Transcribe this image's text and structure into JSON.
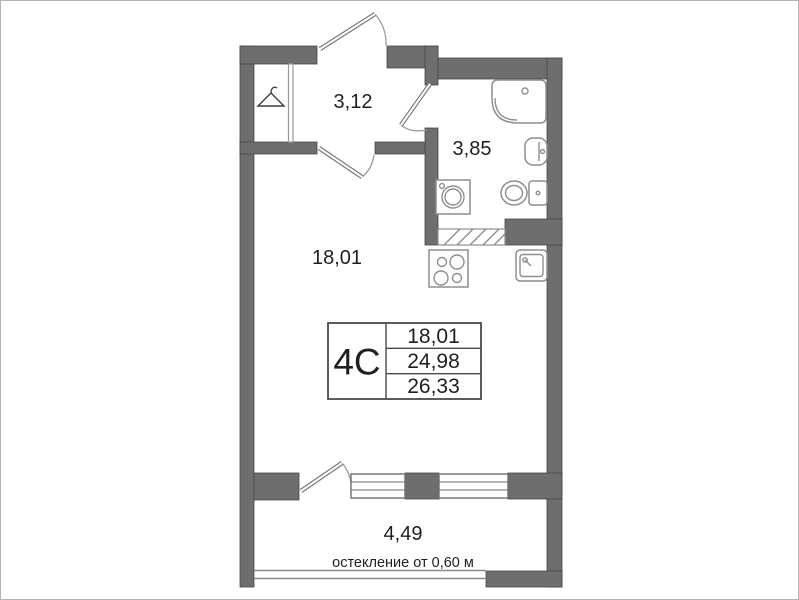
{
  "rooms": {
    "hallway": {
      "area": "3,12"
    },
    "bathroom": {
      "area": "3,85"
    },
    "living": {
      "area": "18,01"
    },
    "balcony": {
      "area": "4,49",
      "note": "остекление от 0,60 м"
    }
  },
  "info_table": {
    "type": "4С",
    "living_area": "18,01",
    "apartment_area": "24,98",
    "total_area": "26,33"
  },
  "colors": {
    "wall": "#6e6e6e",
    "wall_edge": "#474747",
    "fixture_line": "#8e8e8e",
    "text": "#1f1f1f",
    "background": "#ffffff"
  },
  "icons": [
    "hanger-icon",
    "corner-bath-icon",
    "wall-sink-icon",
    "toilet-icon",
    "washing-machine-icon",
    "vent-shaft-hatch-icon",
    "stove-icon",
    "kitchen-sink-icon"
  ]
}
